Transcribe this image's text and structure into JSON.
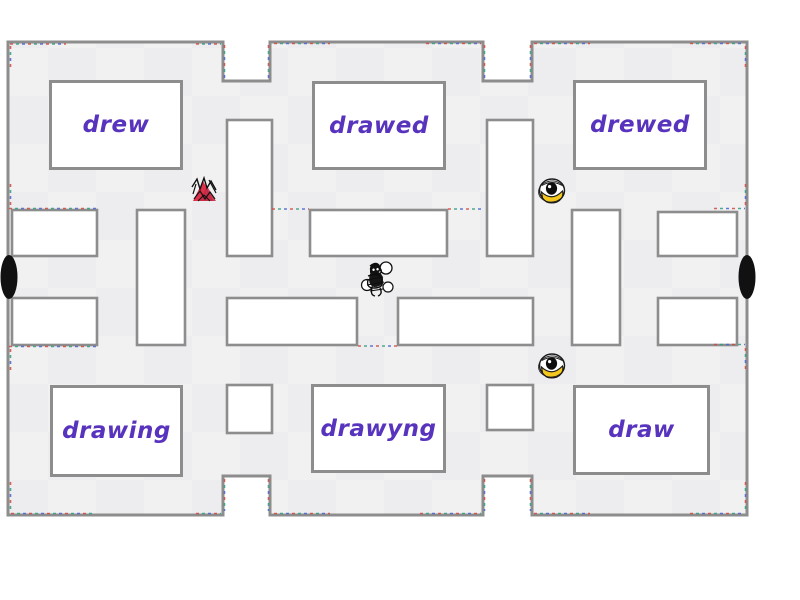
{
  "game": {
    "answers": [
      {
        "label": "drew"
      },
      {
        "label": "drawed"
      },
      {
        "label": "drewed"
      },
      {
        "label": "drawing"
      },
      {
        "label": "drawyng"
      },
      {
        "label": "draw"
      }
    ],
    "characters": {
      "player": "black-doodle-player",
      "enemy_1": "red-scribble-enemy",
      "enemy_2": "yellow-eye-enemy",
      "enemy_3": "yellow-eye-enemy"
    },
    "colors": {
      "path_gray": "#f1f1f2",
      "wall_border": "#8d8d8d",
      "answer_text_purple": "#5833bd",
      "enemy_red": "#e0304a",
      "enemy_yellow": "#f3c71e",
      "tunnel_black": "#111111",
      "zone_dash_red": "#cf4a3f",
      "zone_dash_teal": "#2f9e82",
      "zone_dash_blue": "#4a63cf"
    }
  }
}
